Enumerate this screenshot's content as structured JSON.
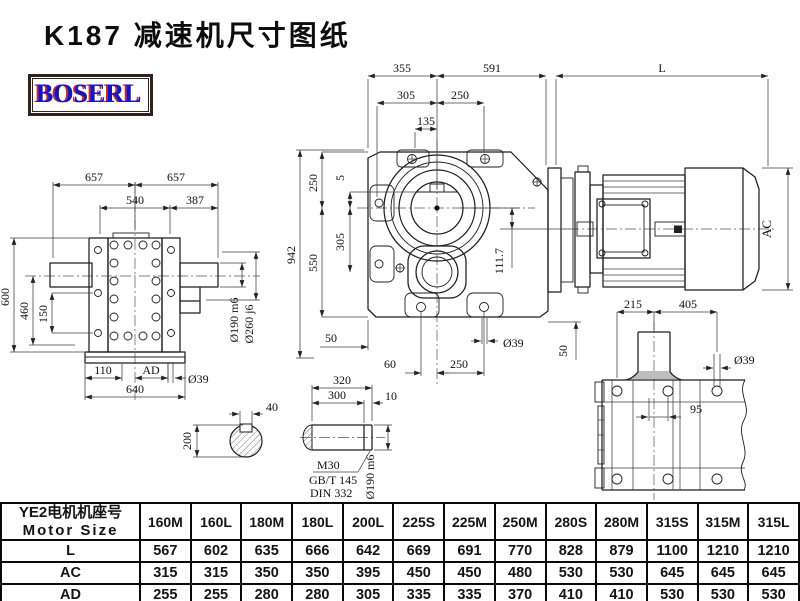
{
  "title": "K187 减速机尺寸图纸",
  "logo": {
    "text": "BOSERL",
    "text_color": "#1414c4",
    "shadow_color": "#bf2d26",
    "frame_color": "#33201a"
  },
  "views": {
    "front": {
      "d355": "355",
      "d591": "591",
      "dl": "L",
      "d305": "305",
      "d250": "250",
      "d135": "135",
      "d942": "942",
      "dv250": "250",
      "dv5": "5",
      "dv305": "305",
      "dv550": "550",
      "d1117": "111.7",
      "dr50": "50",
      "db50": "50",
      "db60": "60",
      "db250": "250",
      "db39": "Ø39"
    },
    "side": {
      "d657a": "657",
      "d657b": "657",
      "d540": "540",
      "d387": "387",
      "d600": "600",
      "d460": "460",
      "d150": "150",
      "d110": "110",
      "dad": "AD",
      "d640": "640",
      "d39": "Ø39",
      "d190": "Ø190 m6",
      "d260": "Ø260 j6"
    },
    "motor": {
      "dac": "AC"
    },
    "plan": {
      "d215": "215",
      "d405": "405",
      "d39": "Ø39",
      "d95": "95"
    },
    "section": {
      "d40": "40",
      "d200": "200"
    },
    "shaft": {
      "d320": "320",
      "d300": "300",
      "d10": "10",
      "m30": "M30",
      "std1": "GB/T 145",
      "std2": "DIN 332",
      "d190": "Ø190 m6"
    }
  },
  "table": {
    "header_line1": "YE2电机机座号",
    "header_line2": "Motor Size",
    "columns": [
      "160M",
      "160L",
      "180M",
      "180L",
      "200L",
      "225S",
      "225M",
      "250M",
      "280S",
      "280M",
      "315S",
      "315M",
      "315L"
    ],
    "rows": [
      {
        "label": "L",
        "values": [
          "567",
          "602",
          "635",
          "666",
          "642",
          "669",
          "691",
          "770",
          "828",
          "879",
          "1100",
          "1210",
          "1210"
        ]
      },
      {
        "label": "AC",
        "values": [
          "315",
          "315",
          "350",
          "350",
          "395",
          "450",
          "450",
          "480",
          "530",
          "530",
          "645",
          "645",
          "645"
        ]
      },
      {
        "label": "AD",
        "values": [
          "255",
          "255",
          "280",
          "280",
          "305",
          "335",
          "335",
          "370",
          "410",
          "410",
          "530",
          "530",
          "530"
        ]
      }
    ]
  }
}
